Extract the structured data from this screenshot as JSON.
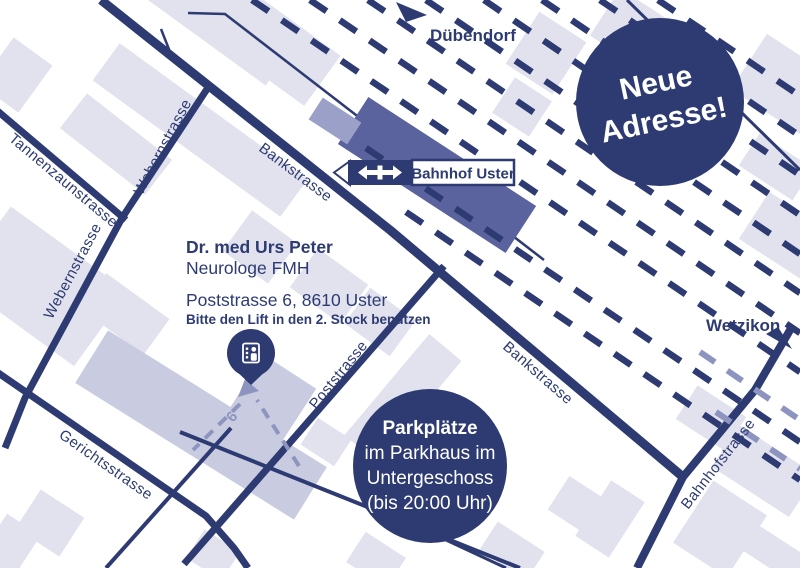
{
  "colors": {
    "navy": "#2d3b72",
    "station": "#5b639e",
    "platform": "#9aa0c7",
    "building": "#e1e2ee",
    "building_dark": "#c9cce0",
    "route": "#8e94c0",
    "background": "#ffffff"
  },
  "destinations": {
    "north": "Dübendorf",
    "east": "Wetzikon"
  },
  "station": {
    "name": "Bahnhof Uster"
  },
  "streets": {
    "tannenzaunstrasse": "Tannenzaunstrasse",
    "webernstrasse": "Webernstrasse",
    "bankstrasse": "Bankstrasse",
    "poststrasse": "Poststrasse",
    "gerichtsstrasse": "Gerichtsstrasse",
    "bahnhofstrasse": "Bahnhofstrasse"
  },
  "practice": {
    "name": "Dr. med Urs Peter",
    "specialty": "Neurologe FMH",
    "address": "Poststrasse 6, 8610 Uster",
    "note": "Bitte den Lift in den 2. Stock benützen",
    "house_number": "6"
  },
  "badges": {
    "new_address": {
      "lines": [
        "Neue",
        "Adresse!"
      ]
    },
    "parking": {
      "lines": [
        "Parkplätze",
        "im Parkhaus im",
        "Untergeschoss",
        "(bis 20:00 Uhr)"
      ]
    }
  }
}
